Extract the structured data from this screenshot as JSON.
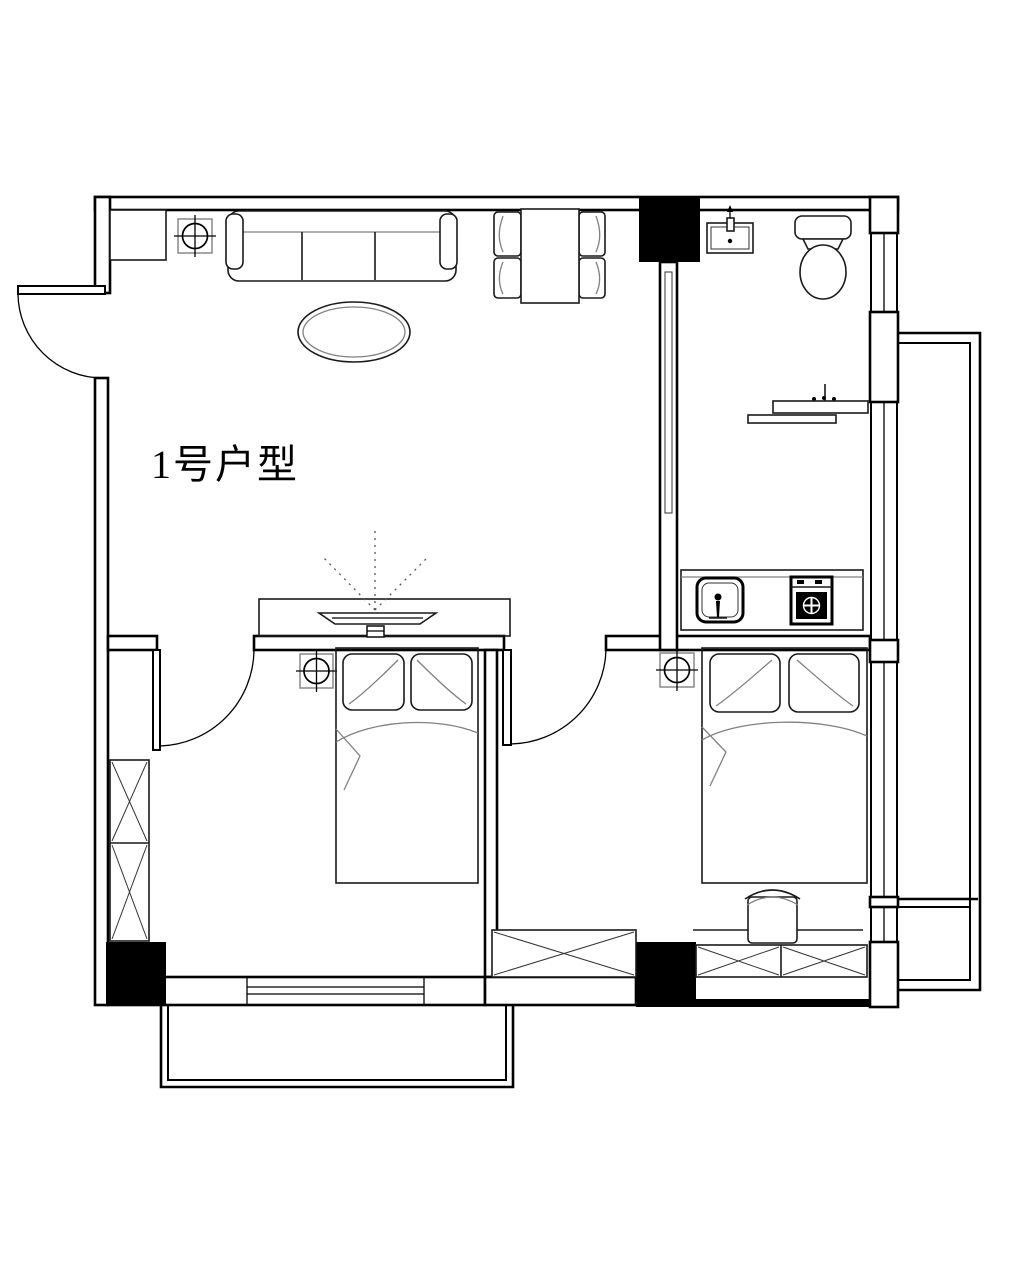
{
  "page": {
    "background": "#ffffff"
  },
  "plan": {
    "unit_label": "1号户型",
    "palette": {
      "wall_line": "#000000",
      "furniture_line": "#1a1a1a",
      "detail_line": "#808080",
      "paper_fill": "#ffffff",
      "column_fill": "#000000"
    },
    "rooms": [
      {
        "name": "living-dining-room",
        "items": [
          "entry-door",
          "entry-cabinet",
          "column-marker",
          "sofa-3-seat",
          "oval-coffee-table",
          "dining-table",
          "dining-chair",
          "dining-chair",
          "dining-chair",
          "dining-chair",
          "tv",
          "tv-cabinet"
        ]
      },
      {
        "name": "bathroom",
        "items": [
          "washbasin",
          "toilet",
          "vanity-shelf",
          "sliding-door-panel",
          "window"
        ]
      },
      {
        "name": "kitchen-strip",
        "items": [
          "kitchen-counter",
          "kitchen-sink",
          "cooktop"
        ]
      },
      {
        "name": "bedroom-left",
        "items": [
          "swing-door",
          "column-marker",
          "double-bed",
          "tall-wardrobe",
          "window",
          "structural-column"
        ]
      },
      {
        "name": "bedroom-right",
        "items": [
          "swing-door",
          "column-marker",
          "double-bed",
          "stool",
          "low-wardrobe",
          "alcove-wardrobe",
          "structural-column",
          "window"
        ]
      },
      {
        "name": "balcony-right",
        "items": []
      },
      {
        "name": "balcony-bottom",
        "items": []
      }
    ]
  }
}
